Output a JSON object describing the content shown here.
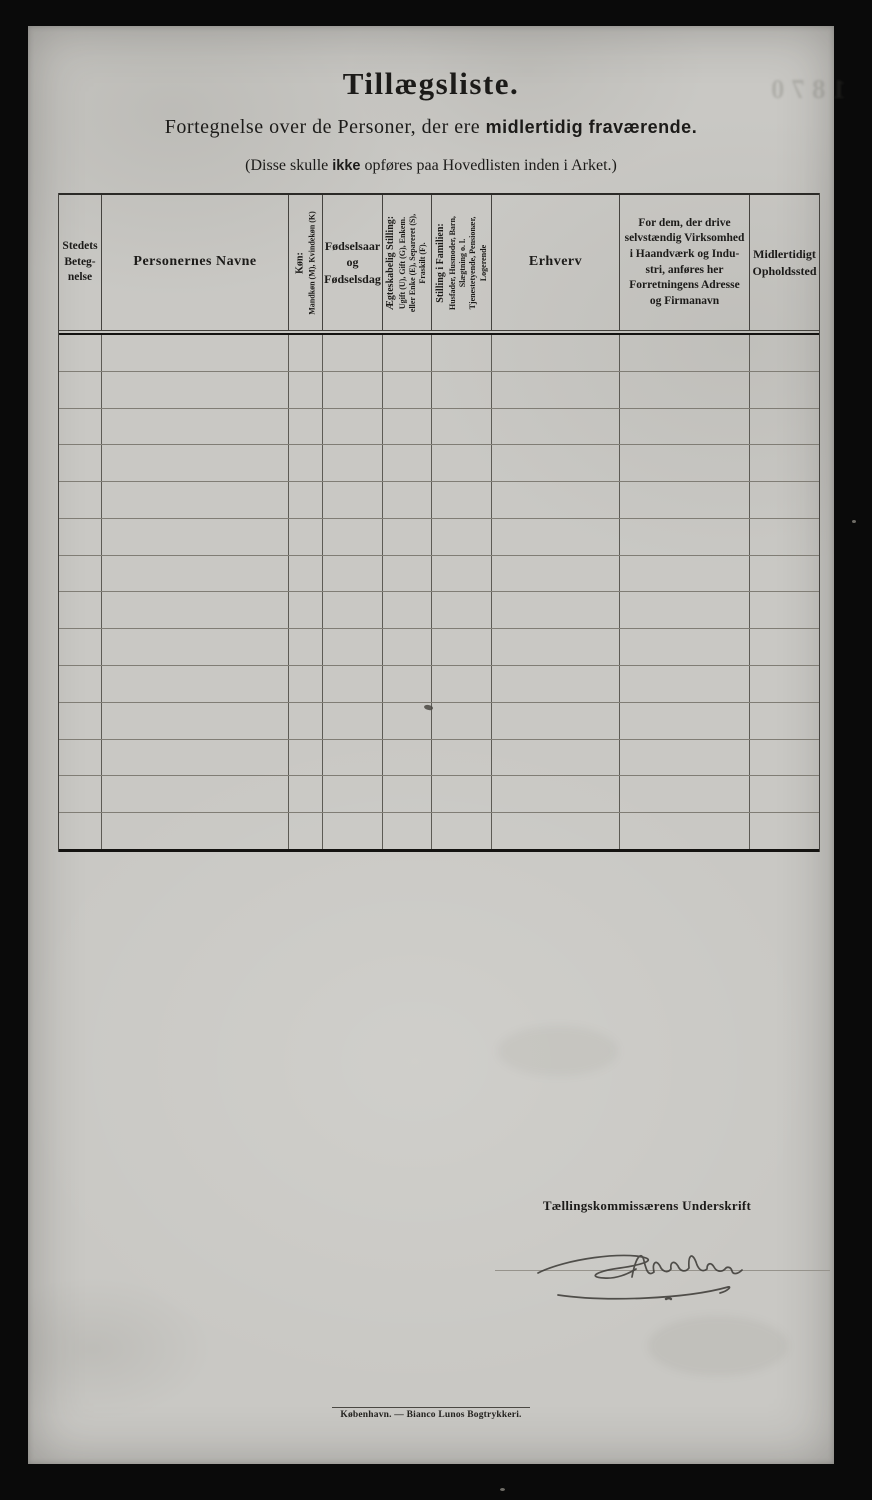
{
  "colors": {
    "background": "#0a0a0a",
    "paper": "#c9c8c4",
    "ink": "#1c1b19",
    "table_border": "#2b2a27",
    "row_line": "#807d75"
  },
  "header": {
    "title": "Tillægsliste.",
    "subtitle_prefix": "Fortegnelse over de Personer, der ere",
    "subtitle_emphasis": "midlertidig fraværende.",
    "note_prefix": "(Disse skulle",
    "note_emphasis": "ikke",
    "note_suffix": "opføres paa Hovedlisten inden i Arket.)",
    "bleed_through_text": "1870"
  },
  "table": {
    "row_count": 14,
    "columns": [
      {
        "name": "stedets-betegnelse",
        "rotated": false,
        "label_lines": [
          "Stedets",
          "Beteg-",
          "nelse"
        ]
      },
      {
        "name": "personernes-navne",
        "rotated": false,
        "label": "Personernes Navne"
      },
      {
        "name": "kon",
        "rotated": true,
        "label_lines": [
          "Køn:",
          "Mandkøn (M), Kvindekøn (K)"
        ]
      },
      {
        "name": "fodselsaar-og-fodselsdag",
        "rotated": false,
        "label_lines": [
          "Fødselsaar",
          "og",
          "Fødselsdag"
        ]
      },
      {
        "name": "aegteskabelig-stilling",
        "rotated": true,
        "label_lines": [
          "Ægteskabelig Stilling:",
          "Ugift (U), Gift (G), Enkem.",
          "eller Enke (E), Separeret (S),",
          "Fraskilt (F)."
        ]
      },
      {
        "name": "stilling-i-familien",
        "rotated": true,
        "label_lines": [
          "Stilling i Familien:",
          "Husfader, Husmoder, Barn,",
          "Slægtning o. l.",
          "Tjenestetyende, Pensionær,",
          "Logerende"
        ]
      },
      {
        "name": "erhverv",
        "rotated": false,
        "label": "Erhverv"
      },
      {
        "name": "virksomhed-adresse",
        "rotated": false,
        "label_lines": [
          "For dem, der drive",
          "selvstændig Virksomhed",
          "i Haandværk og Indu-",
          "stri, anføres her",
          "Forretningens Adresse",
          "og Firmanavn"
        ]
      },
      {
        "name": "midlertidigt-opholdssted",
        "rotated": false,
        "label_lines": [
          "Midlertidigt",
          "Opholdssted"
        ]
      }
    ]
  },
  "signature": {
    "label": "Tællingskommissærens Underskrift",
    "handwritten_signature_present": true
  },
  "footer": {
    "imprint": "København. — Bianco Lunos Bogtrykkeri."
  }
}
